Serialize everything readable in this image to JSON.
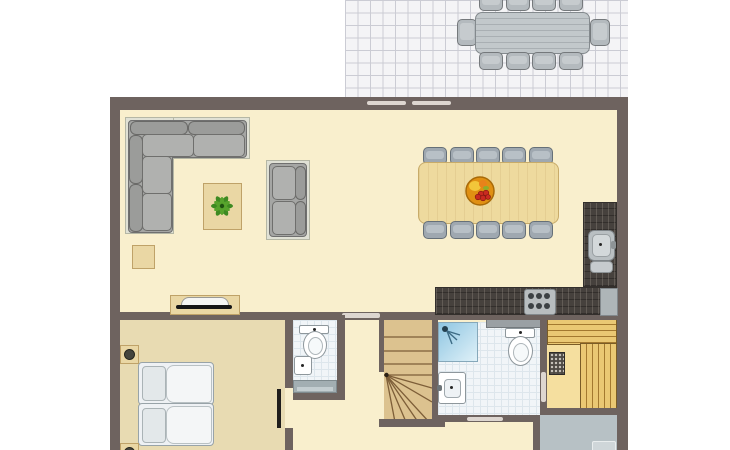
{
  "colors": {
    "pageBg": "#ffffff",
    "wall": "#6e635f",
    "doorMarker": "#ddd6d0",
    "floorMain": "#f9efcd",
    "floorBedroom": "#e8dbb2",
    "terraceFloor": "#f4f4f6",
    "terraceGrid": "#cbccd4",
    "wood": "#ead7a4",
    "woodBorder": "#bfa268",
    "tableTop": "#eeda9e",
    "stairWood": "#dcc28f",
    "stairLine": "#7d5e38",
    "saunaBench": "#eac873",
    "saunaFloor": "#f5df9f",
    "counter": "#46413d",
    "sofa": "#a5a6a4",
    "sofaBorder": "#707070",
    "sofaMat": "#e0e1d5",
    "sofaMatBorder": "#b5b7a5",
    "chair": "#9fa8b0",
    "chairBorder": "#667078",
    "chairSeat": "#b8c0c6",
    "outdoor": "#b4babe",
    "outdoorBorder": "#75797c",
    "tile": "#f1f5f8",
    "tileLine": "#dde6ec",
    "showerBlue": "#a5d2e8",
    "entranceFloor": "#b7c1c5",
    "appliance": "#aeb5b8",
    "fixtureBorder": "#8e979c",
    "bed": "#eef1f4",
    "bedBorder": "#98a3a8",
    "pillow": "#e3e8ea",
    "tv": "#161616",
    "plantGreen": "#3e8a22",
    "bowlOrange": "#e09012",
    "grapeRed": "#c92b20",
    "fruitYellow": "#f2c63a",
    "lampDark": "#45453d"
  },
  "floorplan": {
    "type": "floor-plan",
    "rooms": [
      {
        "name": "terrace",
        "furniture": [
          "outdoor-dining-table",
          "outdoor-chairs"
        ],
        "chair_count": 10
      },
      {
        "name": "living-dining-room",
        "furniture": [
          "corner-sofa",
          "two-seat-sofa",
          "coffee-table",
          "potted-plant",
          "side-table",
          "tv-sideboard",
          "dining-table",
          "dining-chairs",
          "fruit-bowl"
        ],
        "dining_chair_count": 10
      },
      {
        "name": "kitchen",
        "furniture": [
          "l-shaped-counter",
          "sink",
          "stove",
          "appliance"
        ],
        "stove_burners": 6
      },
      {
        "name": "bedroom",
        "furniture": [
          "single-bed",
          "single-bed",
          "bedside-lamp",
          "bedside-lamp"
        ],
        "bed_count": 2
      },
      {
        "name": "wc",
        "furniture": [
          "toilet",
          "washbasin",
          "cabinet"
        ]
      },
      {
        "name": "staircase",
        "furniture": [
          "winder-stairs"
        ]
      },
      {
        "name": "bathroom",
        "furniture": [
          "shower",
          "toilet",
          "washbasin",
          "shelf"
        ]
      },
      {
        "name": "sauna",
        "furniture": [
          "benches",
          "sauna-heater"
        ]
      },
      {
        "name": "entrance",
        "furniture": [
          "doormat"
        ]
      }
    ]
  }
}
